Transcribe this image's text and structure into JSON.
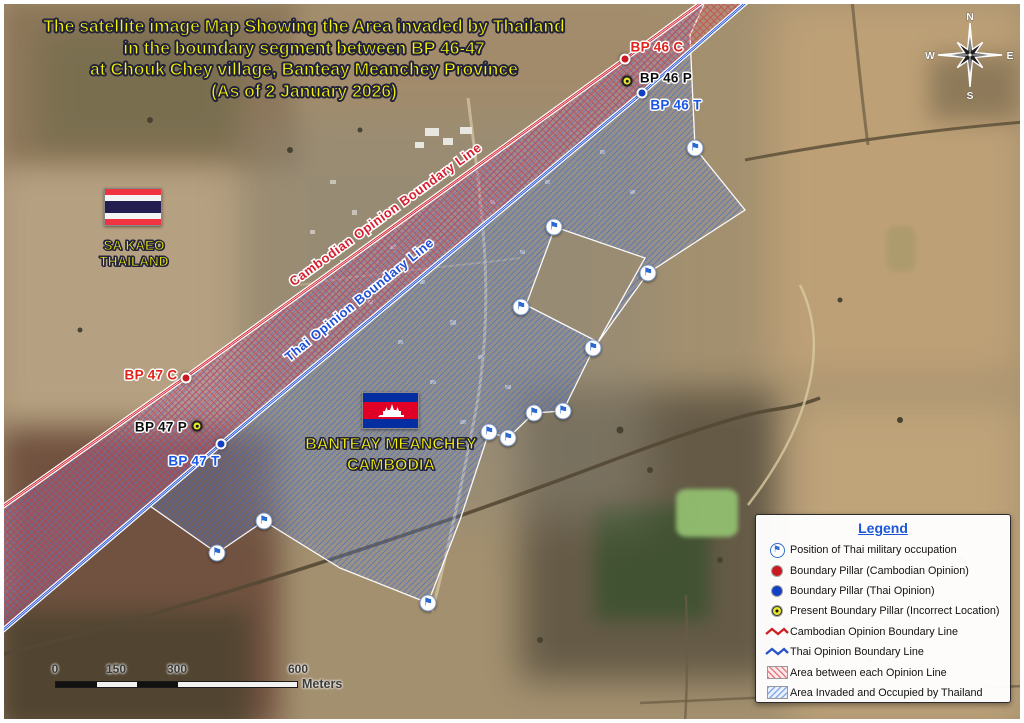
{
  "title": {
    "lines": [
      "The satellite image Map Showing the Area invaded by Thailand",
      "in the boundary segment between BP 46-47",
      "at Chouk Chey village, Banteay Meanchey Province",
      "(As of 2 January 2026)"
    ]
  },
  "regions": {
    "thailand": {
      "line1": "SA KAEO",
      "line2": "THAILAND"
    },
    "cambodia": {
      "line1": "BANTEAY MEANCHEY",
      "line2": "CAMBODIA"
    }
  },
  "boundary_lines": {
    "cambodian": {
      "label": "Cambodian Opinion Boundary Line",
      "color": "#d61f2e"
    },
    "thai": {
      "label": "Thai Opinion Boundary Line",
      "color": "#1e4ed8"
    }
  },
  "pillars": [
    {
      "id": "BP46C",
      "label": "BP 46 C",
      "type": "cambodian",
      "x": 625,
      "y": 59,
      "lx": 657,
      "ly": 47
    },
    {
      "id": "BP46P",
      "label": "BP 46 P",
      "type": "present",
      "x": 627,
      "y": 81,
      "lx": 666,
      "ly": 78
    },
    {
      "id": "BP46T",
      "label": "BP 46 T",
      "type": "thai",
      "x": 642,
      "y": 93,
      "lx": 676,
      "ly": 105
    },
    {
      "id": "BP47C",
      "label": "BP 47 C",
      "type": "cambodian",
      "x": 186,
      "y": 378,
      "lx": 151,
      "ly": 375
    },
    {
      "id": "BP47P",
      "label": "BP 47 P",
      "type": "present",
      "x": 197,
      "y": 426,
      "lx": 161,
      "ly": 427
    },
    {
      "id": "BP47T",
      "label": "BP 47 T",
      "type": "thai",
      "x": 221,
      "y": 444,
      "lx": 194,
      "ly": 461
    }
  ],
  "military_positions": [
    {
      "x": 695,
      "y": 148
    },
    {
      "x": 554,
      "y": 227
    },
    {
      "x": 648,
      "y": 273
    },
    {
      "x": 521,
      "y": 307
    },
    {
      "x": 593,
      "y": 348
    },
    {
      "x": 563,
      "y": 411
    },
    {
      "x": 534,
      "y": 413
    },
    {
      "x": 489,
      "y": 432
    },
    {
      "x": 508,
      "y": 438
    },
    {
      "x": 264,
      "y": 521
    },
    {
      "x": 217,
      "y": 553
    },
    {
      "x": 428,
      "y": 603
    }
  ],
  "legend": {
    "title": "Legend",
    "items": [
      {
        "icon": "thai-military-flag",
        "label": "Position of Thai military occupation"
      },
      {
        "icon": "red-dot",
        "label": "Boundary Pillar (Cambodian Opinion)"
      },
      {
        "icon": "blue-dot",
        "label": "Boundary Pillar (Thai Opinion)"
      },
      {
        "icon": "yellow-dot",
        "label": "Present Boundary Pillar (Incorrect Location)"
      },
      {
        "icon": "red-line",
        "label": "Cambodian Opinion Boundary Line"
      },
      {
        "icon": "blue-line",
        "label": "Thai Opinion Boundary Line"
      },
      {
        "icon": "red-hatch",
        "label": "Area between each Opinion Line"
      },
      {
        "icon": "blue-hatch",
        "label": "Area Invaded and Occupied by Thailand"
      }
    ]
  },
  "scale_bar": {
    "tick_labels": [
      "0",
      "150",
      "300",
      "600"
    ],
    "unit": "Meters"
  },
  "compass": {
    "n": "N",
    "e": "E",
    "s": "S",
    "w": "W"
  },
  "icons": {
    "military_flag": "⚑"
  },
  "colors": {
    "title_text": "#f7f400",
    "legend_title": "#1b57d6",
    "cambodian_line": "#d61f2e",
    "thai_line": "#1e4ed8",
    "pillar_cambodian": "#c81a20",
    "pillar_thai": "#1240c4",
    "pillar_present": "#e9e72b",
    "between_area_hatch": "#d93a4e",
    "invaded_area_hatch": "#3c6ed7"
  }
}
